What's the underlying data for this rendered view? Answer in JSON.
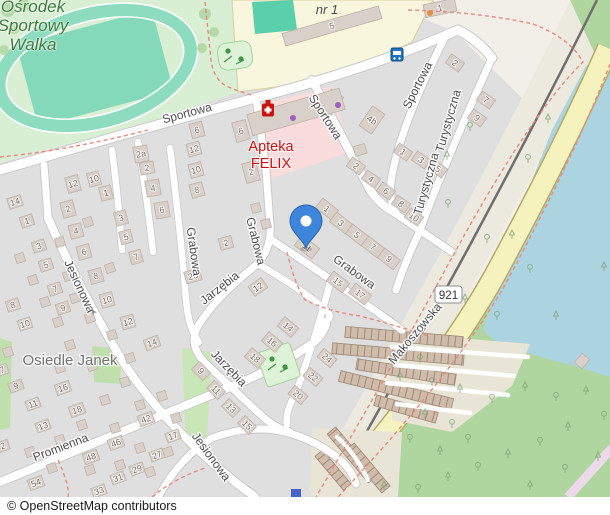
{
  "map": {
    "attribution": "© OpenStreetMap contributors",
    "road_ref": "921",
    "place_labels": {
      "sports_center": {
        "lines": [
          "Ośrodek",
          "Sportowy",
          "Walka"
        ]
      },
      "neighbourhood": "Osiedle Janek",
      "school": "nr 1"
    },
    "pharmacy": {
      "name_line1": "Apteka",
      "name_line2": "FELIX"
    },
    "street_labels": [
      {
        "text": "Sportowa",
        "x": 188,
        "y": 117,
        "rot": -15
      },
      {
        "text": "Sportowa",
        "x": 322,
        "y": 119,
        "rot": 57
      },
      {
        "text": "Sportowa",
        "x": 421,
        "y": 87,
        "rot": -63
      },
      {
        "text": "Turystyczna",
        "x": 452,
        "y": 122,
        "rot": -74
      },
      {
        "text": "Turystyczna",
        "x": 430,
        "y": 185,
        "rot": -74
      },
      {
        "text": "Grabowa",
        "x": 190,
        "y": 252,
        "rot": 82
      },
      {
        "text": "Grabowa",
        "x": 252,
        "y": 242,
        "rot": 76
      },
      {
        "text": "Grabowa",
        "x": 352,
        "y": 275,
        "rot": 36
      },
      {
        "text": "Jarzębia",
        "x": 222,
        "y": 291,
        "rot": -38
      },
      {
        "text": "Jarzębia",
        "x": 226,
        "y": 371,
        "rot": 46
      },
      {
        "text": "Jesionowa",
        "x": 76,
        "y": 288,
        "rot": 65
      },
      {
        "text": "Jesionowa",
        "x": 208,
        "y": 459,
        "rot": 54
      },
      {
        "text": "Promienna",
        "x": 62,
        "y": 451,
        "rot": -21
      },
      {
        "text": "Makoszowska",
        "x": 418,
        "y": 336,
        "rot": -50
      }
    ],
    "buildings": [
      [
        332,
        26,
        -16,
        100,
        13,
        "5"
      ],
      [
        440,
        8,
        -12,
        32,
        13,
        "1"
      ],
      [
        330,
        104,
        35,
        15,
        26,
        "4c"
      ],
      [
        372,
        120,
        35,
        15,
        24,
        "4b"
      ],
      [
        296,
        112,
        -16,
        96,
        22,
        ""
      ],
      [
        360,
        150,
        -16,
        12,
        10,
        ""
      ],
      [
        197,
        130,
        -15,
        13,
        15,
        "6"
      ],
      [
        194,
        149,
        -15,
        13,
        13,
        "12"
      ],
      [
        196,
        170,
        -15,
        13,
        14,
        "10"
      ],
      [
        197,
        190,
        -15,
        13,
        14,
        "8"
      ],
      [
        241,
        131,
        -15,
        14,
        20,
        "6"
      ],
      [
        251,
        172,
        -15,
        14,
        20,
        "2"
      ],
      [
        226,
        243,
        -15,
        13,
        12,
        "2"
      ],
      [
        141,
        154,
        -10,
        14,
        16,
        "2a"
      ],
      [
        147,
        168,
        -10,
        14,
        12,
        "2"
      ],
      [
        153,
        188,
        -10,
        14,
        16,
        "4"
      ],
      [
        162,
        210,
        -10,
        14,
        16,
        "6"
      ],
      [
        73,
        184,
        -15,
        13,
        16,
        "12"
      ],
      [
        94,
        179,
        -15,
        12,
        14,
        "10"
      ],
      [
        68,
        209,
        -15,
        13,
        16,
        "2"
      ],
      [
        106,
        193,
        -15,
        12,
        14,
        "1"
      ],
      [
        76,
        231,
        -15,
        13,
        14,
        "4"
      ],
      [
        121,
        218,
        -15,
        12,
        14,
        "3"
      ],
      [
        84,
        252,
        -15,
        13,
        14,
        "6"
      ],
      [
        126,
        237,
        -15,
        12,
        13,
        "5"
      ],
      [
        136,
        257,
        -15,
        12,
        13,
        "7"
      ],
      [
        96,
        276,
        -15,
        13,
        14,
        "8"
      ],
      [
        107,
        300,
        -15,
        13,
        14,
        "10"
      ],
      [
        128,
        322,
        -15,
        13,
        13,
        "12"
      ],
      [
        15,
        202,
        -18,
        14,
        11,
        "14"
      ],
      [
        27,
        221,
        -18,
        13,
        11,
        "1"
      ],
      [
        39,
        246,
        -18,
        13,
        11,
        "3"
      ],
      [
        46,
        265,
        -18,
        13,
        11,
        "5"
      ],
      [
        55,
        289,
        -18,
        13,
        11,
        "7"
      ],
      [
        13,
        305,
        -18,
        13,
        11,
        "8"
      ],
      [
        63,
        308,
        -18,
        13,
        11,
        "9"
      ],
      [
        25,
        324,
        -18,
        13,
        11,
        "10"
      ],
      [
        193,
        276,
        -15,
        16,
        12,
        "23"
      ],
      [
        327,
        209,
        38,
        20,
        12,
        "1"
      ],
      [
        341,
        223,
        38,
        20,
        12,
        "3"
      ],
      [
        357,
        235,
        38,
        20,
        12,
        "5"
      ],
      [
        373,
        247,
        38,
        20,
        12,
        "7"
      ],
      [
        389,
        259,
        38,
        20,
        12,
        "9"
      ],
      [
        307,
        247,
        38,
        22,
        13,
        "11"
      ],
      [
        338,
        282,
        38,
        20,
        12,
        "15"
      ],
      [
        360,
        294,
        38,
        20,
        12,
        "17"
      ],
      [
        356,
        166,
        35,
        16,
        11,
        "2"
      ],
      [
        371,
        179,
        35,
        16,
        11,
        "4"
      ],
      [
        386,
        191,
        35,
        16,
        11,
        "6"
      ],
      [
        455,
        63,
        35,
        16,
        11,
        "2"
      ],
      [
        486,
        100,
        35,
        16,
        11,
        "7"
      ],
      [
        477,
        118,
        35,
        16,
        11,
        "9"
      ],
      [
        403,
        152,
        35,
        16,
        11,
        "1"
      ],
      [
        421,
        160,
        35,
        16,
        11,
        "3"
      ],
      [
        438,
        169,
        35,
        16,
        11,
        "5"
      ],
      [
        401,
        204,
        35,
        16,
        11,
        "8"
      ],
      [
        414,
        217,
        35,
        16,
        11,
        "10"
      ],
      [
        258,
        287,
        -35,
        16,
        12,
        "12"
      ],
      [
        288,
        327,
        40,
        18,
        12,
        "14"
      ],
      [
        272,
        342,
        40,
        18,
        12,
        "16"
      ],
      [
        255,
        358,
        40,
        18,
        12,
        "18"
      ],
      [
        327,
        358,
        40,
        17,
        11,
        "24"
      ],
      [
        313,
        377,
        40,
        17,
        11,
        "22"
      ],
      [
        298,
        395,
        40,
        17,
        11,
        "20"
      ],
      [
        201,
        371,
        45,
        16,
        11,
        "9"
      ],
      [
        216,
        390,
        45,
        16,
        11,
        "11"
      ],
      [
        231,
        408,
        45,
        16,
        11,
        "13"
      ],
      [
        247,
        425,
        45,
        16,
        11,
        "15"
      ],
      [
        152,
        343,
        -20,
        15,
        11,
        "14"
      ],
      [
        63,
        388,
        -20,
        15,
        11,
        "16"
      ],
      [
        77,
        410,
        -20,
        15,
        11,
        "18"
      ],
      [
        16,
        386,
        -20,
        14,
        10,
        "9"
      ],
      [
        33,
        404,
        -20,
        14,
        10,
        "11"
      ],
      [
        43,
        426,
        -20,
        14,
        10,
        "13"
      ],
      [
        146,
        419,
        -20,
        15,
        11,
        "42"
      ],
      [
        116,
        443,
        -20,
        15,
        11,
        "46"
      ],
      [
        91,
        457,
        -20,
        15,
        11,
        "48"
      ],
      [
        173,
        436,
        -20,
        14,
        10,
        "17"
      ],
      [
        157,
        455,
        -20,
        14,
        10,
        "27"
      ],
      [
        137,
        469,
        -20,
        14,
        10,
        "29"
      ],
      [
        118,
        478,
        -20,
        14,
        10,
        "31"
      ],
      [
        99,
        491,
        -20,
        14,
        10,
        "33"
      ],
      [
        36,
        483,
        -20,
        15,
        11,
        "54"
      ],
      [
        3,
        446,
        -20,
        12,
        10,
        "2"
      ],
      [
        2,
        370,
        -20,
        12,
        10,
        "7"
      ],
      [
        582,
        361,
        -50,
        12,
        10,
        ""
      ],
      [
        88,
        222,
        -18,
        9,
        9,
        ""
      ],
      [
        60,
        242,
        -18,
        9,
        9,
        ""
      ],
      [
        20,
        258,
        -18,
        9,
        9,
        ""
      ],
      [
        68,
        276,
        -18,
        9,
        9,
        ""
      ],
      [
        33,
        280,
        -18,
        9,
        9,
        ""
      ],
      [
        45,
        302,
        -18,
        9,
        9,
        ""
      ],
      [
        75,
        298,
        -18,
        9,
        9,
        ""
      ],
      [
        90,
        318,
        -18,
        9,
        9,
        ""
      ],
      [
        58,
        322,
        -18,
        9,
        9,
        ""
      ],
      [
        110,
        268,
        -18,
        9,
        9,
        ""
      ],
      [
        8,
        352,
        -18,
        9,
        9,
        ""
      ],
      [
        70,
        345,
        -18,
        9,
        9,
        ""
      ],
      [
        112,
        335,
        -18,
        9,
        9,
        ""
      ],
      [
        130,
        358,
        -18,
        9,
        9,
        ""
      ],
      [
        60,
        368,
        -18,
        9,
        9,
        ""
      ],
      [
        92,
        366,
        -18,
        9,
        9,
        ""
      ],
      [
        125,
        382,
        -18,
        9,
        9,
        ""
      ],
      [
        105,
        400,
        -18,
        9,
        9,
        ""
      ],
      [
        140,
        405,
        -18,
        9,
        9,
        ""
      ],
      [
        82,
        425,
        -18,
        9,
        9,
        ""
      ],
      [
        60,
        440,
        -18,
        9,
        9,
        ""
      ],
      [
        115,
        428,
        -18,
        9,
        9,
        ""
      ],
      [
        30,
        452,
        -18,
        9,
        9,
        ""
      ],
      [
        52,
        468,
        -18,
        9,
        9,
        ""
      ],
      [
        90,
        470,
        -18,
        9,
        9,
        ""
      ],
      [
        120,
        465,
        -18,
        9,
        9,
        ""
      ],
      [
        150,
        472,
        -18,
        9,
        9,
        ""
      ],
      [
        168,
        452,
        -18,
        9,
        9,
        ""
      ],
      [
        140,
        448,
        -18,
        9,
        9,
        ""
      ],
      [
        176,
        418,
        -18,
        9,
        9,
        ""
      ],
      [
        162,
        396,
        -18,
        9,
        9,
        ""
      ],
      [
        256,
        208,
        -15,
        9,
        9,
        ""
      ],
      [
        266,
        224,
        -15,
        9,
        9,
        ""
      ]
    ],
    "trees": [
      [
        470,
        128
      ],
      [
        447,
        157
      ],
      [
        487,
        240
      ],
      [
        512,
        236
      ],
      [
        530,
        270
      ],
      [
        604,
        268
      ],
      [
        497,
        317
      ],
      [
        556,
        317
      ],
      [
        448,
        205
      ],
      [
        465,
        300
      ],
      [
        420,
        360
      ],
      [
        400,
        378
      ],
      [
        432,
        383
      ],
      [
        460,
        390
      ],
      [
        492,
        400
      ],
      [
        525,
        388
      ],
      [
        556,
        398
      ],
      [
        586,
        392
      ],
      [
        604,
        417
      ],
      [
        568,
        428
      ],
      [
        540,
        443
      ],
      [
        508,
        455
      ],
      [
        478,
        468
      ],
      [
        448,
        478
      ],
      [
        418,
        490
      ],
      [
        530,
        487
      ],
      [
        565,
        470
      ],
      [
        598,
        458
      ],
      [
        410,
        440
      ],
      [
        440,
        452
      ],
      [
        468,
        440
      ],
      [
        425,
        415
      ],
      [
        452,
        425
      ],
      [
        384,
        487
      ],
      [
        528,
        160
      ],
      [
        548,
        120
      ]
    ],
    "garage_rows": [
      [
        404,
        337,
        118,
        11,
        5
      ],
      [
        398,
        354,
        132,
        11,
        5
      ],
      [
        406,
        372,
        100,
        11,
        9
      ],
      [
        396,
        390,
        116,
        11,
        14
      ],
      [
        406,
        409,
        64,
        11,
        16
      ],
      [
        352,
        455,
        64,
        11,
        50
      ],
      [
        368,
        468,
        56,
        11,
        50
      ],
      [
        333,
        470,
        44,
        10,
        50
      ]
    ],
    "icons": [
      "bus-stop-icon",
      "pharmacy-icon",
      "location-pin-icon",
      "playground-icon",
      "tree-icon",
      "shop-dot-icon",
      "oneway-arrow-icon",
      "poi-square-icon"
    ],
    "colors": {
      "land": "#f2efe9",
      "residential": "#e0dfdf",
      "building": "#d9d0c9",
      "building_outline": "#bfb2a6",
      "water": "#abd4e0",
      "wood": "#aed69e",
      "grass": "#bfe0ac",
      "pitch": "#8edcbf",
      "school": "#f8f6dd",
      "healthcare": "#fadcdc",
      "road_secondary": "#f5f2bd",
      "railway": "#6f6f6f",
      "path_red": "#ea8a7e",
      "pin_blue": "#3e86dc",
      "pharmacy_red": "#cc1111",
      "street_label": "#4c4c4c",
      "housenumber": "#776a5e",
      "sports_label_green": "#3c7c3c",
      "place_label_gray": "#737373",
      "garage": "#cfbcab"
    }
  }
}
